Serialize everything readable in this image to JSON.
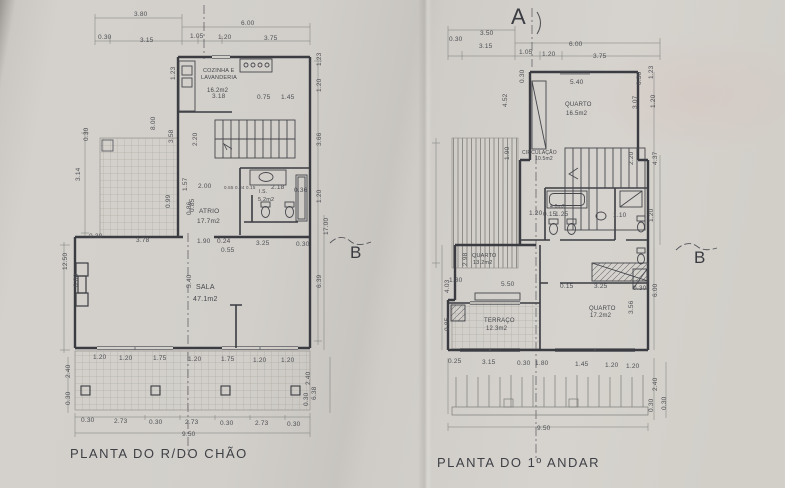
{
  "document": {
    "type": "architectural floor plans, photographed paper sheet",
    "paper_color": "#d2cfca",
    "line_color": "#3b3c42",
    "dim_text_color": "#4e4f55"
  },
  "plans": [
    {
      "id": "ground-floor",
      "title": "PLANTA DO R/DO CHÃO",
      "room_labels": [
        {
          "t": "COZINHA E",
          "x": 203,
          "y": 69,
          "s": 5.5
        },
        {
          "t": "LAVANDERIA",
          "x": 201,
          "y": 76,
          "s": 5.5
        },
        {
          "t": "16.2m2",
          "x": 207,
          "y": 88,
          "s": 6
        },
        {
          "t": "ATRIO",
          "x": 199,
          "y": 209,
          "s": 6.5
        },
        {
          "t": "17.7m2",
          "x": 197,
          "y": 219,
          "s": 6.5
        },
        {
          "t": "I.S.",
          "x": 259,
          "y": 190,
          "s": 5
        },
        {
          "t": "5.2m2",
          "x": 258,
          "y": 198,
          "s": 5.5
        },
        {
          "t": "SALA",
          "x": 196,
          "y": 284,
          "s": 7
        },
        {
          "t": "47.1m2",
          "x": 193,
          "y": 296,
          "s": 7
        }
      ],
      "dim_labels": [
        {
          "t": "3.80",
          "x": 134,
          "y": 12
        },
        {
          "t": "0.30",
          "x": 98,
          "y": 35
        },
        {
          "t": "3.15",
          "x": 140,
          "y": 38
        },
        {
          "t": "6.00",
          "x": 241,
          "y": 21
        },
        {
          "t": "1.05",
          "x": 190,
          "y": 34
        },
        {
          "t": "1.20",
          "x": 218,
          "y": 35
        },
        {
          "t": "3.75",
          "x": 264,
          "y": 36
        },
        {
          "t": "3.18",
          "x": 212,
          "y": 94
        },
        {
          "t": "0.75",
          "x": 257,
          "y": 95
        },
        {
          "t": "1.45",
          "x": 281,
          "y": 95
        },
        {
          "t": "1.23",
          "x": 171,
          "y": 80,
          "rot": 1
        },
        {
          "t": "1.23",
          "x": 317,
          "y": 66,
          "rot": 1
        },
        {
          "t": "1.20",
          "x": 317,
          "y": 92,
          "rot": 1
        },
        {
          "t": "3.66",
          "x": 317,
          "y": 146,
          "rot": 1
        },
        {
          "t": "1.20",
          "x": 317,
          "y": 203,
          "rot": 1
        },
        {
          "t": "17.00",
          "x": 324,
          "y": 235,
          "rot": 1
        },
        {
          "t": "6.39",
          "x": 317,
          "y": 288,
          "rot": 1
        },
        {
          "t": "8.00",
          "x": 151,
          "y": 130,
          "rot": 1
        },
        {
          "t": "3.58",
          "x": 169,
          "y": 143,
          "rot": 1
        },
        {
          "t": "2.20",
          "x": 193,
          "y": 146,
          "rot": 1
        },
        {
          "t": "0.30",
          "x": 84,
          "y": 141,
          "rot": 1
        },
        {
          "t": "3.14",
          "x": 76,
          "y": 181,
          "rot": 1
        },
        {
          "t": "1.57",
          "x": 183,
          "y": 191,
          "rot": 1
        },
        {
          "t": "0.99",
          "x": 166,
          "y": 208,
          "rot": 1
        },
        {
          "t": "0.85",
          "x": 190,
          "y": 212,
          "rot": 1
        },
        {
          "t": "2.00",
          "x": 198,
          "y": 184
        },
        {
          "t": "0.55 0.84 0.15",
          "x": 224,
          "y": 186,
          "s": 4.5
        },
        {
          "t": "2.18",
          "x": 271,
          "y": 185
        },
        {
          "t": "0.36",
          "x": 294,
          "y": 188
        },
        {
          "t": "0.86",
          "x": 187,
          "y": 215,
          "rot": 1
        },
        {
          "t": "12.50",
          "x": 63,
          "y": 270,
          "rot": 1
        },
        {
          "t": "6.00",
          "x": 74,
          "y": 287,
          "rot": 1
        },
        {
          "t": "0.30",
          "x": 89,
          "y": 234
        },
        {
          "t": "3.78",
          "x": 136,
          "y": 238
        },
        {
          "t": "1.90",
          "x": 197,
          "y": 239
        },
        {
          "t": "0.24",
          "x": 217,
          "y": 239
        },
        {
          "t": "0.55",
          "x": 221,
          "y": 248
        },
        {
          "t": "3.25",
          "x": 256,
          "y": 241
        },
        {
          "t": "0.30",
          "x": 296,
          "y": 242
        },
        {
          "t": "5.40",
          "x": 187,
          "y": 288,
          "rot": 1
        },
        {
          "t": "1.20",
          "x": 93,
          "y": 355
        },
        {
          "t": "1.20",
          "x": 119,
          "y": 356
        },
        {
          "t": "1.75",
          "x": 153,
          "y": 356
        },
        {
          "t": "1.20",
          "x": 188,
          "y": 357
        },
        {
          "t": "1.75",
          "x": 221,
          "y": 357
        },
        {
          "t": "1.20",
          "x": 253,
          "y": 358
        },
        {
          "t": "1.20",
          "x": 281,
          "y": 358
        },
        {
          "t": "2.40",
          "x": 66,
          "y": 378,
          "rot": 1
        },
        {
          "t": "0.30",
          "x": 66,
          "y": 405,
          "rot": 1
        },
        {
          "t": "0.30",
          "x": 81,
          "y": 418
        },
        {
          "t": "2.73",
          "x": 114,
          "y": 419
        },
        {
          "t": "0.30",
          "x": 149,
          "y": 420
        },
        {
          "t": "2.73",
          "x": 185,
          "y": 420
        },
        {
          "t": "0.30",
          "x": 220,
          "y": 421
        },
        {
          "t": "2.73",
          "x": 255,
          "y": 421
        },
        {
          "t": "0.30",
          "x": 287,
          "y": 422
        },
        {
          "t": "9.50",
          "x": 182,
          "y": 432
        },
        {
          "t": "2.40",
          "x": 306,
          "y": 385,
          "rot": 1
        },
        {
          "t": "0.30",
          "x": 304,
          "y": 406,
          "rot": 1
        },
        {
          "t": "6.38",
          "x": 312,
          "y": 400,
          "rot": 1
        }
      ],
      "markers": [
        {
          "t": "B",
          "x": 350,
          "y": 244,
          "s": 17
        }
      ]
    },
    {
      "id": "first-floor",
      "title": "PLANTA DO 1º ANDAR",
      "room_labels": [
        {
          "t": "QUARTO",
          "x": 565,
          "y": 102,
          "s": 6
        },
        {
          "t": "16.5m2",
          "x": 566,
          "y": 111,
          "s": 6
        },
        {
          "t": "CIRCULAÇÃO",
          "x": 522,
          "y": 151,
          "s": 5
        },
        {
          "t": "10.5m2",
          "x": 535,
          "y": 157,
          "s": 5
        },
        {
          "t": "4.0m2",
          "x": 550,
          "y": 205,
          "s": 5
        },
        {
          "t": "QUARTO",
          "x": 472,
          "y": 254,
          "s": 5.5
        },
        {
          "t": "13.2m2",
          "x": 473,
          "y": 261,
          "s": 5.5
        },
        {
          "t": "TERRAÇO",
          "x": 484,
          "y": 318,
          "s": 6
        },
        {
          "t": "12.3m2",
          "x": 486,
          "y": 326,
          "s": 6
        },
        {
          "t": "QUARTO",
          "x": 589,
          "y": 306,
          "s": 6
        },
        {
          "t": "17.2m2",
          "x": 590,
          "y": 313,
          "s": 6
        }
      ],
      "dim_labels": [
        {
          "t": "3.50",
          "x": 480,
          "y": 31
        },
        {
          "t": "0.30",
          "x": 449,
          "y": 37
        },
        {
          "t": "3.15",
          "x": 479,
          "y": 44
        },
        {
          "t": "6.00",
          "x": 569,
          "y": 42
        },
        {
          "t": "1.05",
          "x": 519,
          "y": 50
        },
        {
          "t": "1.20",
          "x": 542,
          "y": 52
        },
        {
          "t": "3.75",
          "x": 593,
          "y": 54
        },
        {
          "t": "5.40",
          "x": 570,
          "y": 80
        },
        {
          "t": "0.30",
          "x": 520,
          "y": 83,
          "rot": 1
        },
        {
          "t": "1.23",
          "x": 649,
          "y": 79,
          "rot": 1
        },
        {
          "t": "0.30",
          "x": 637,
          "y": 85,
          "rot": 1
        },
        {
          "t": "3.07",
          "x": 633,
          "y": 109,
          "rot": 1
        },
        {
          "t": "1.20",
          "x": 651,
          "y": 108,
          "rot": 1
        },
        {
          "t": "4.52",
          "x": 503,
          "y": 107,
          "rot": 1
        },
        {
          "t": "1.90",
          "x": 505,
          "y": 160,
          "rot": 1
        },
        {
          "t": "2.20",
          "x": 629,
          "y": 165,
          "rot": 1
        },
        {
          "t": "4.37",
          "x": 653,
          "y": 165,
          "rot": 1
        },
        {
          "t": "1.20",
          "x": 529,
          "y": 211
        },
        {
          "t": "0.15",
          "x": 543,
          "y": 212
        },
        {
          "t": "1.25",
          "x": 555,
          "y": 212
        },
        {
          "t": "1.10",
          "x": 613,
          "y": 213
        },
        {
          "t": "1.20",
          "x": 649,
          "y": 222,
          "rot": 1
        },
        {
          "t": "2.98",
          "x": 463,
          "y": 266,
          "rot": 1
        },
        {
          "t": "1.30",
          "x": 449,
          "y": 278
        },
        {
          "t": "5.50",
          "x": 501,
          "y": 282
        },
        {
          "t": "0.15",
          "x": 560,
          "y": 284
        },
        {
          "t": "3.25",
          "x": 594,
          "y": 284
        },
        {
          "t": "0.30",
          "x": 633,
          "y": 286
        },
        {
          "t": "6.00",
          "x": 653,
          "y": 297,
          "rot": 1
        },
        {
          "t": "3.56",
          "x": 629,
          "y": 314,
          "rot": 1
        },
        {
          "t": "4.03",
          "x": 445,
          "y": 293,
          "rot": 1
        },
        {
          "t": "0.85",
          "x": 445,
          "y": 331,
          "rot": 1
        },
        {
          "t": "0.25",
          "x": 448,
          "y": 359
        },
        {
          "t": "3.15",
          "x": 482,
          "y": 360
        },
        {
          "t": "0.30",
          "x": 517,
          "y": 361
        },
        {
          "t": "1.80",
          "x": 535,
          "y": 361
        },
        {
          "t": "1.45",
          "x": 575,
          "y": 362
        },
        {
          "t": "1.20",
          "x": 605,
          "y": 363
        },
        {
          "t": "1.20",
          "x": 626,
          "y": 364
        },
        {
          "t": "9.50",
          "x": 537,
          "y": 426
        },
        {
          "t": "2.40",
          "x": 653,
          "y": 391,
          "rot": 1
        },
        {
          "t": "0.30",
          "x": 649,
          "y": 412,
          "rot": 1
        },
        {
          "t": "0.30",
          "x": 662,
          "y": 410,
          "rot": 1
        }
      ],
      "markers": [
        {
          "t": "A",
          "x": 511,
          "y": 6,
          "s": 22
        },
        {
          "t": "B",
          "x": 694,
          "y": 249,
          "s": 17
        }
      ]
    }
  ]
}
